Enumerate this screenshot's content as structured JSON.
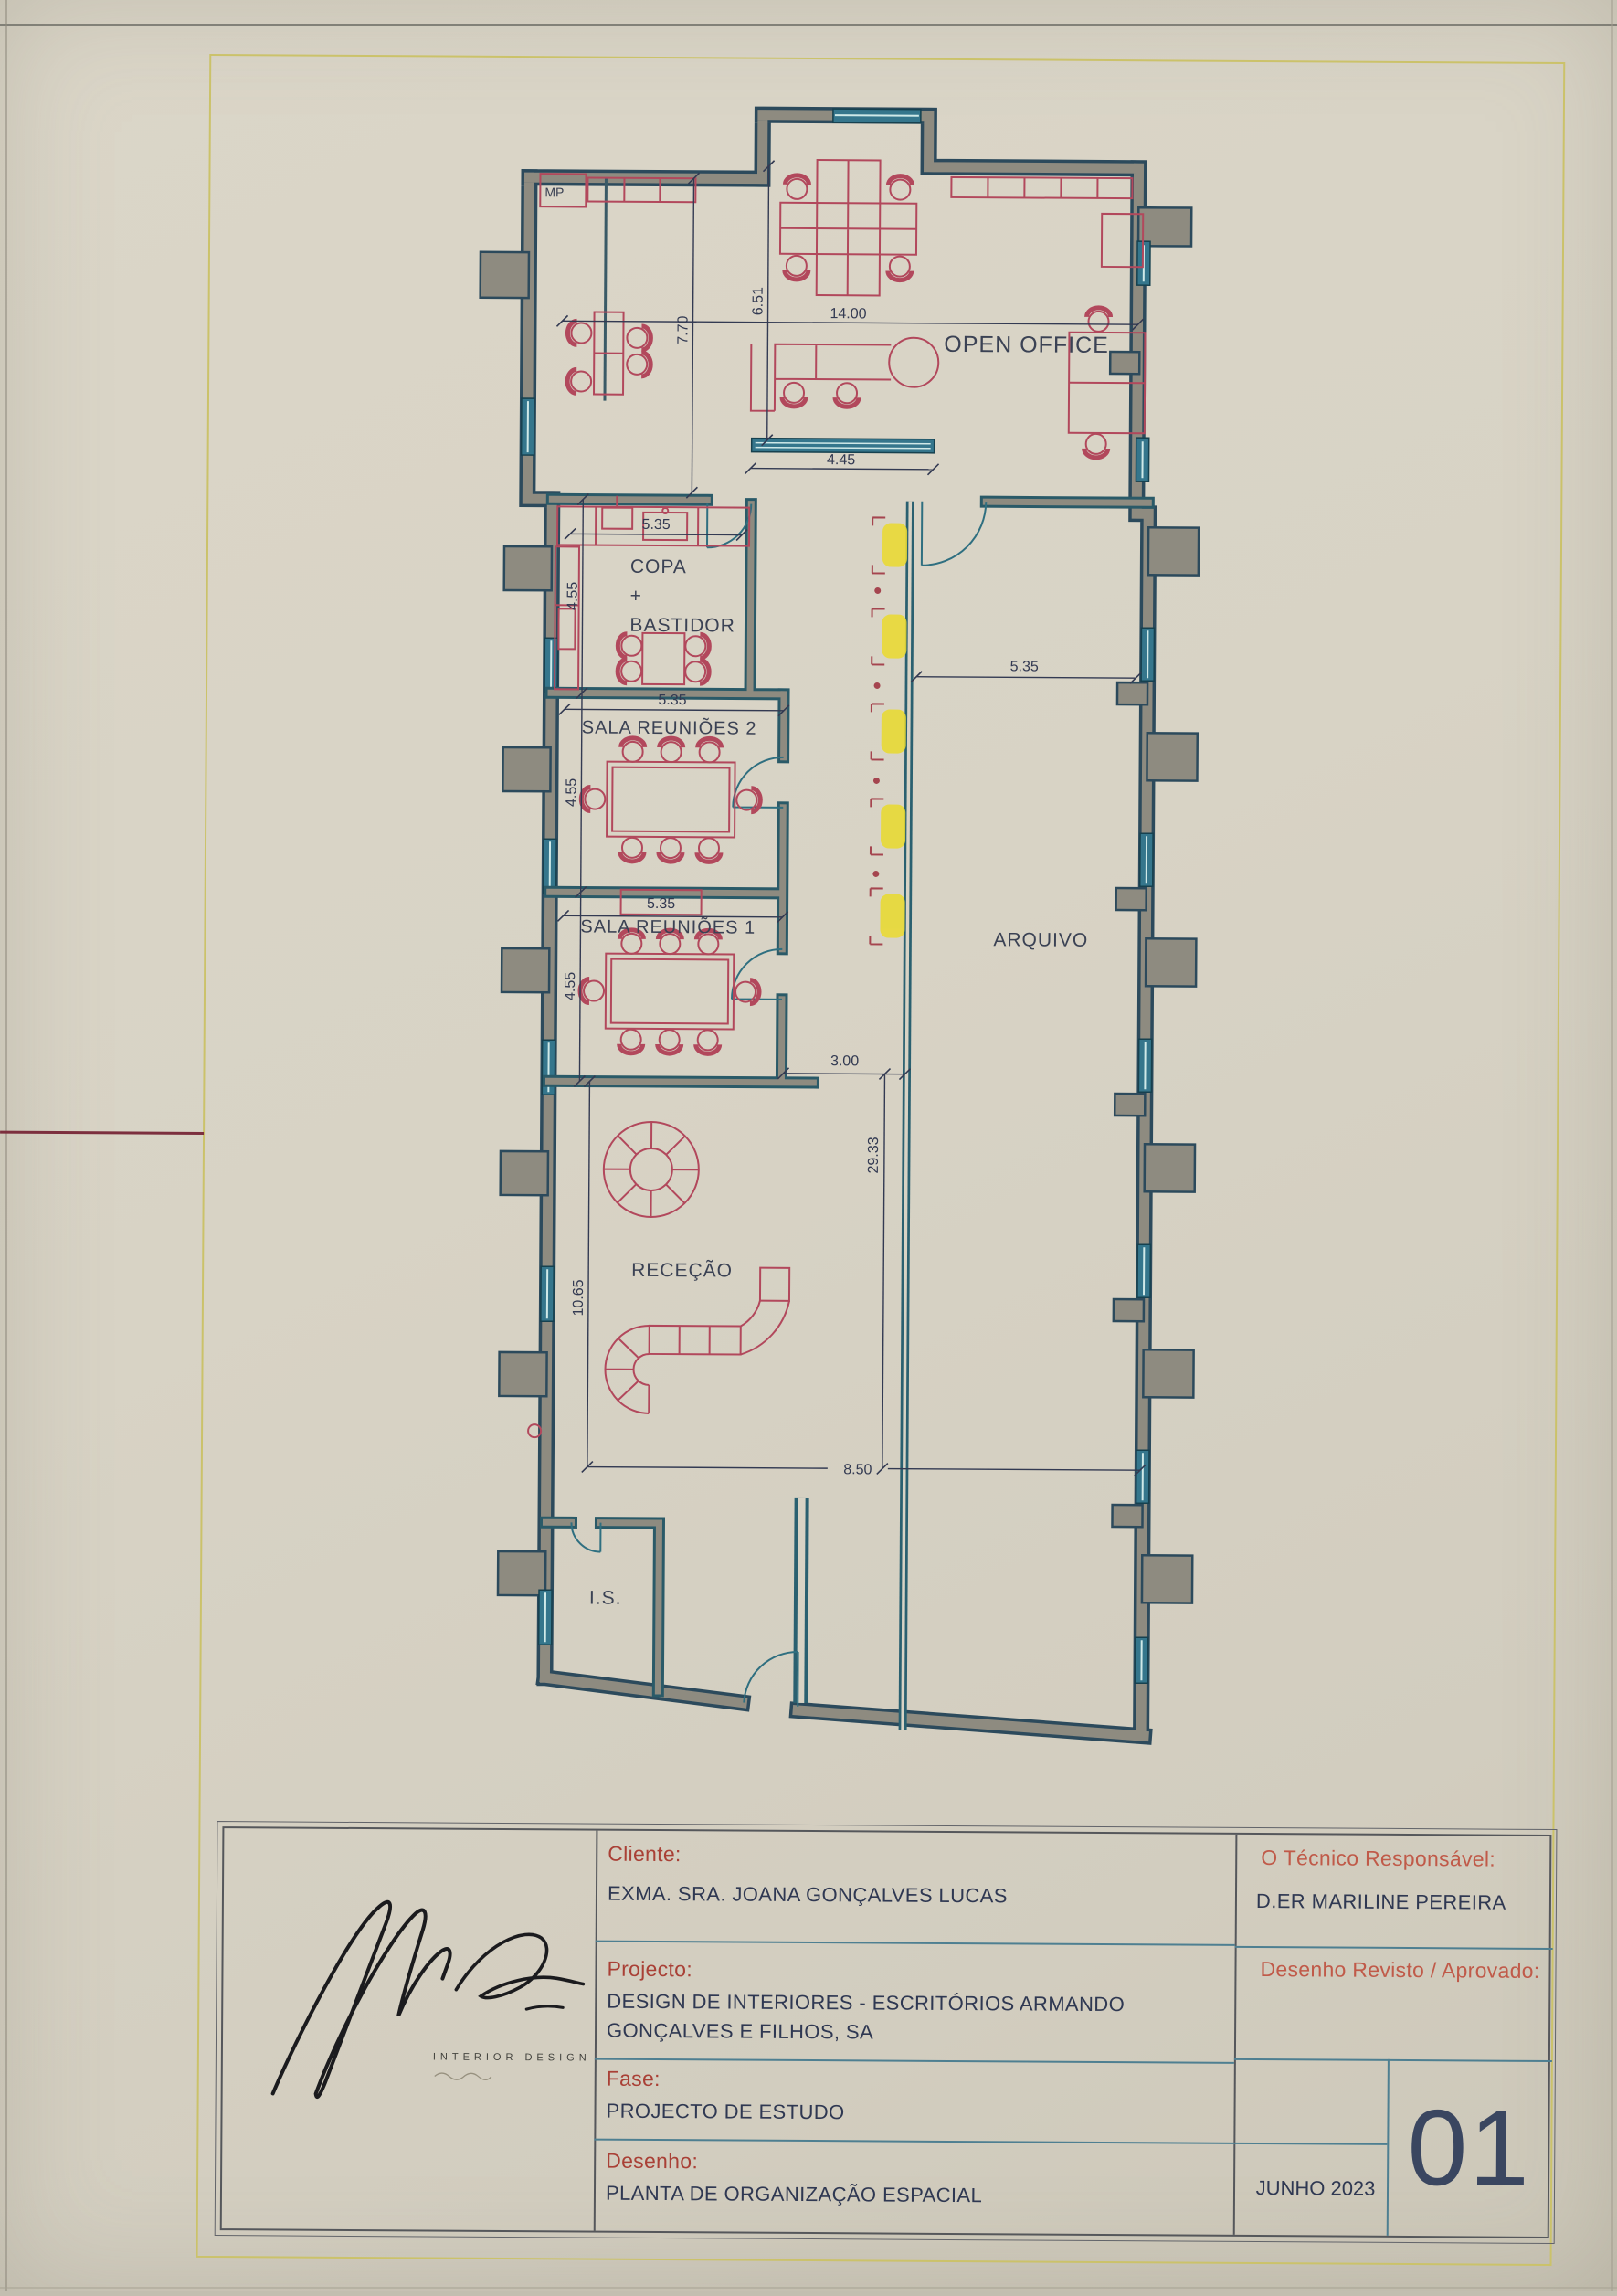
{
  "page": {
    "sheet_bg": "#d8d3c5",
    "frame_color": "#cbc26a",
    "accent_wall": "#2c4a5c",
    "accent_furniture": "#b2485c",
    "accent_highlight": "#e9da32"
  },
  "plan": {
    "labels": {
      "open_office": "OPEN OFFICE",
      "copa_1": "COPA",
      "copa_2": "+",
      "copa_3": "BASTIDOR",
      "sala2": "SALA REUNIÕES 2",
      "sala1": "SALA REUNIÕES 1",
      "arquivo": "ARQUIVO",
      "rececao": "RECEÇÃO",
      "is": "I.S.",
      "mp": "MP"
    },
    "dims": {
      "open_office_width": "14.00",
      "open_office_height_left": "7.70",
      "open_office_height_right": "6.51",
      "corridor_top": "4.45",
      "copa_width": "5.35",
      "copa_height": "4.55",
      "sala2_width": "5.35",
      "sala2_height": "4.55",
      "sala1_width": "5.35",
      "sala1_height": "4.55",
      "arquivo_width": "5.35",
      "corridor_width": "3.00",
      "corridor_length": "29.33",
      "rececao_height": "10.65",
      "rececao_width": "8.50"
    }
  },
  "titleblock": {
    "cliente_label": "Cliente:",
    "cliente_value": "EXMA. SRA. JOANA GONÇALVES LUCAS",
    "projecto_label": "Projecto:",
    "projecto_value_1": "DESIGN DE INTERIORES - ESCRITÓRIOS ARMANDO",
    "projecto_value_2": "GONÇALVES E FILHOS, SA",
    "fase_label": "Fase:",
    "fase_value": "PROJECTO DE ESTUDO",
    "desenho_label": "Desenho:",
    "desenho_value": "PLANTA DE ORGANIZAÇÃO ESPACIAL",
    "tecnico_label": "O Técnico Responsável:",
    "tecnico_value": "D.ER MARILINE PEREIRA",
    "revisto_label": "Desenho Revisto / Aprovado:",
    "date": "JUNHO 2023",
    "sheet_number": "01",
    "logo_subtitle": "INTERIOR DESIGN"
  }
}
